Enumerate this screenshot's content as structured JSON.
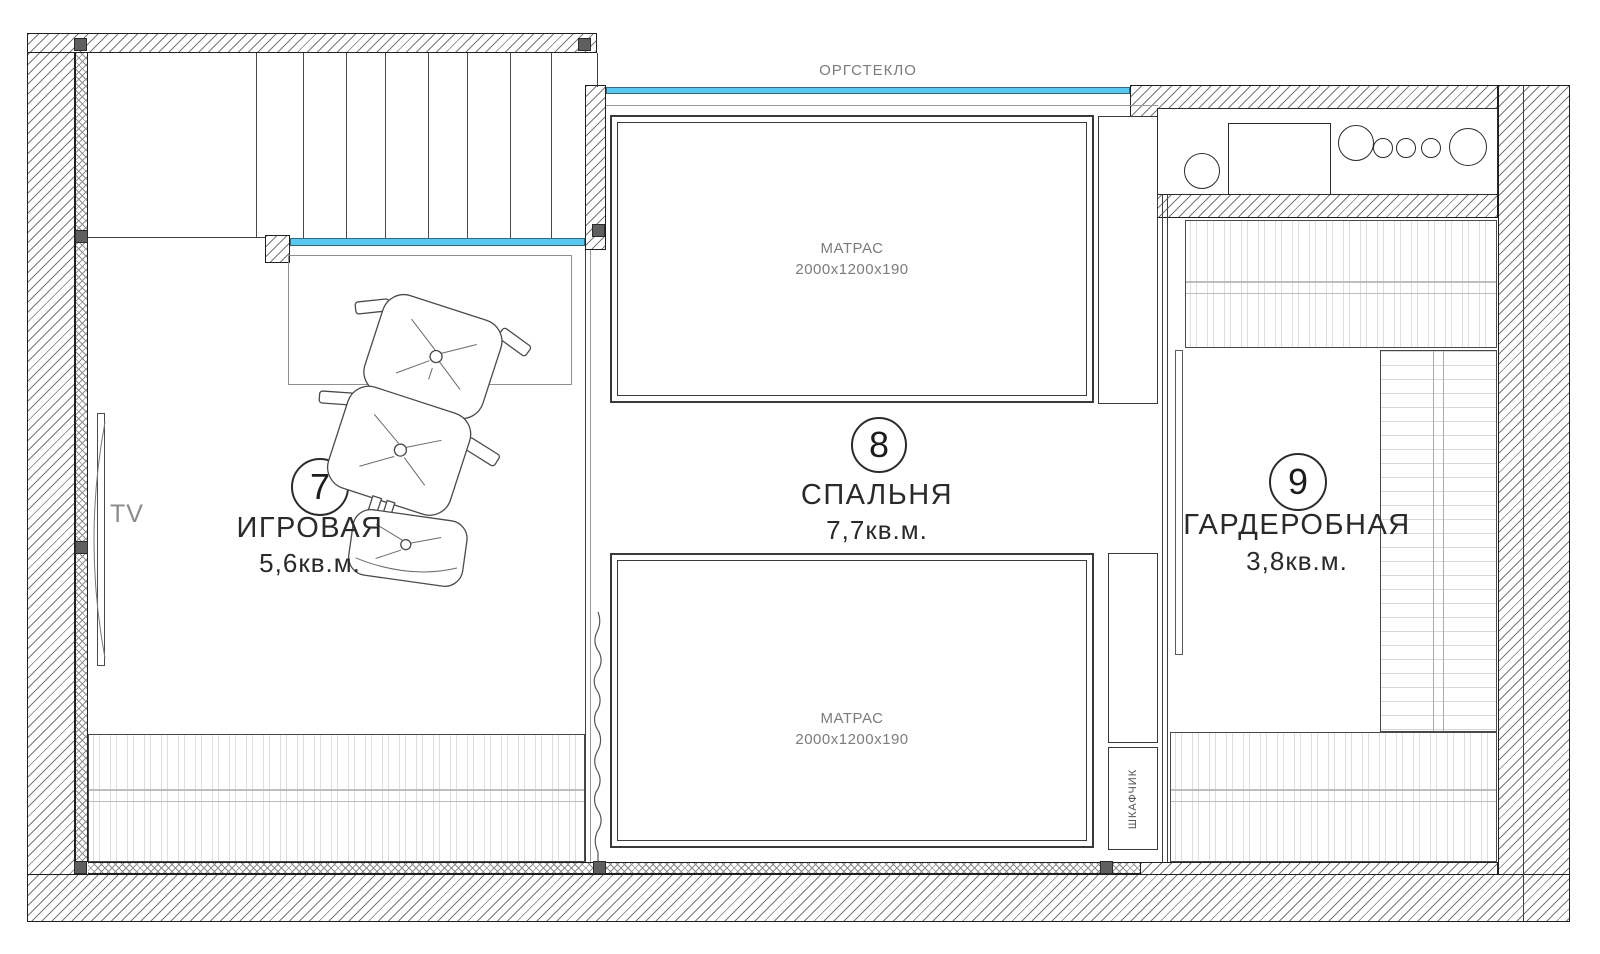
{
  "labels": {
    "glass_partition": "ОРГСТЕКЛО",
    "tv": "TV",
    "cabinet_vertical": "ШКАФЧИК"
  },
  "rooms": [
    {
      "number": "7",
      "name": "ИГРОВАЯ",
      "area": "5,6кв.м."
    },
    {
      "number": "8",
      "name": "СПАЛЬНЯ",
      "area": "7,7кв.м."
    },
    {
      "number": "9",
      "name": "ГАРДЕРОБНАЯ",
      "area": "3,8кв.м."
    }
  ],
  "furniture": {
    "mattress_top": {
      "name": "МАТРАС",
      "dimensions": "2000х1200х190"
    },
    "mattress_bottom": {
      "name": "МАТРАС",
      "dimensions": "2000х1200х190"
    }
  },
  "colors": {
    "glass": "#59c7ee",
    "wall_line": "#1f1f1f",
    "hatch_line": "#787878",
    "marker": "#5f5f5f",
    "label_gray": "#7c7c7c",
    "label_dark": "#2a2a2a"
  }
}
